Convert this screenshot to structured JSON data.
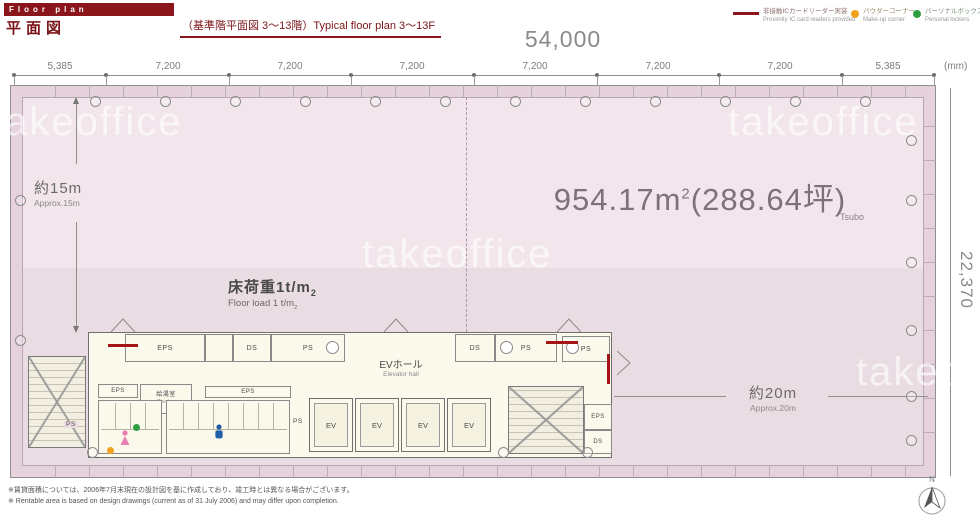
{
  "header": {
    "banner": "Floor plan",
    "title_jp": "平面図",
    "subtitle": "（基準階平面図 3〜13階）Typical floor plan 3〜13F"
  },
  "legend": {
    "items": [
      {
        "type": "line",
        "color": "#8a161c",
        "jp": "非接触ICカードリーダー実装",
        "en": "Proximity IC card readers provided"
      },
      {
        "type": "dot",
        "color": "#f2a21c",
        "jp": "パウダーコーナー",
        "en": "Make-up corner"
      },
      {
        "type": "dot",
        "color": "#2f9e41",
        "jp": "パーソナルボックス",
        "en": "Personal lockers"
      }
    ]
  },
  "dimensions": {
    "overall_width": "54,000",
    "unit_label": "(mm)",
    "overall_height": "22,370",
    "segments": [
      "5,385",
      "7,200",
      "7,200",
      "7,200",
      "7,200",
      "7,200",
      "7,200",
      "5,385"
    ],
    "depth_left_jp": "約15m",
    "depth_left_en": "Approx.15m",
    "depth_right_jp": "約20m",
    "depth_right_en": "Approx.20m"
  },
  "plan": {
    "area_value": "954.17m",
    "area_sup": "2",
    "area_paren": "(288.64坪)",
    "area_paren_sub": "Tsubo",
    "floor_load_jp": "床荷重1t/m",
    "floor_load_sub": "2",
    "floor_load_en": "Floor load 1 t/m",
    "ev_hall_jp": "EVホール",
    "ev_hall_en": "Elevator hall",
    "labels": {
      "eps": "EPS",
      "ds": "DS",
      "ps": "PS",
      "ev": "EV",
      "pantry_jp": "給湯室",
      "pantry_en": "Pantry"
    }
  },
  "watermark": "takeoffice",
  "compass_label": "N",
  "footer": {
    "note_jp": "※賃貸面積については、2006年7月末現在の設計図を基に作成しており、竣工時とは異なる場合がございます。",
    "note_en": "※ Rentable area is based on design drawings (current as of 31 July 2006) and may differ upon completion."
  }
}
